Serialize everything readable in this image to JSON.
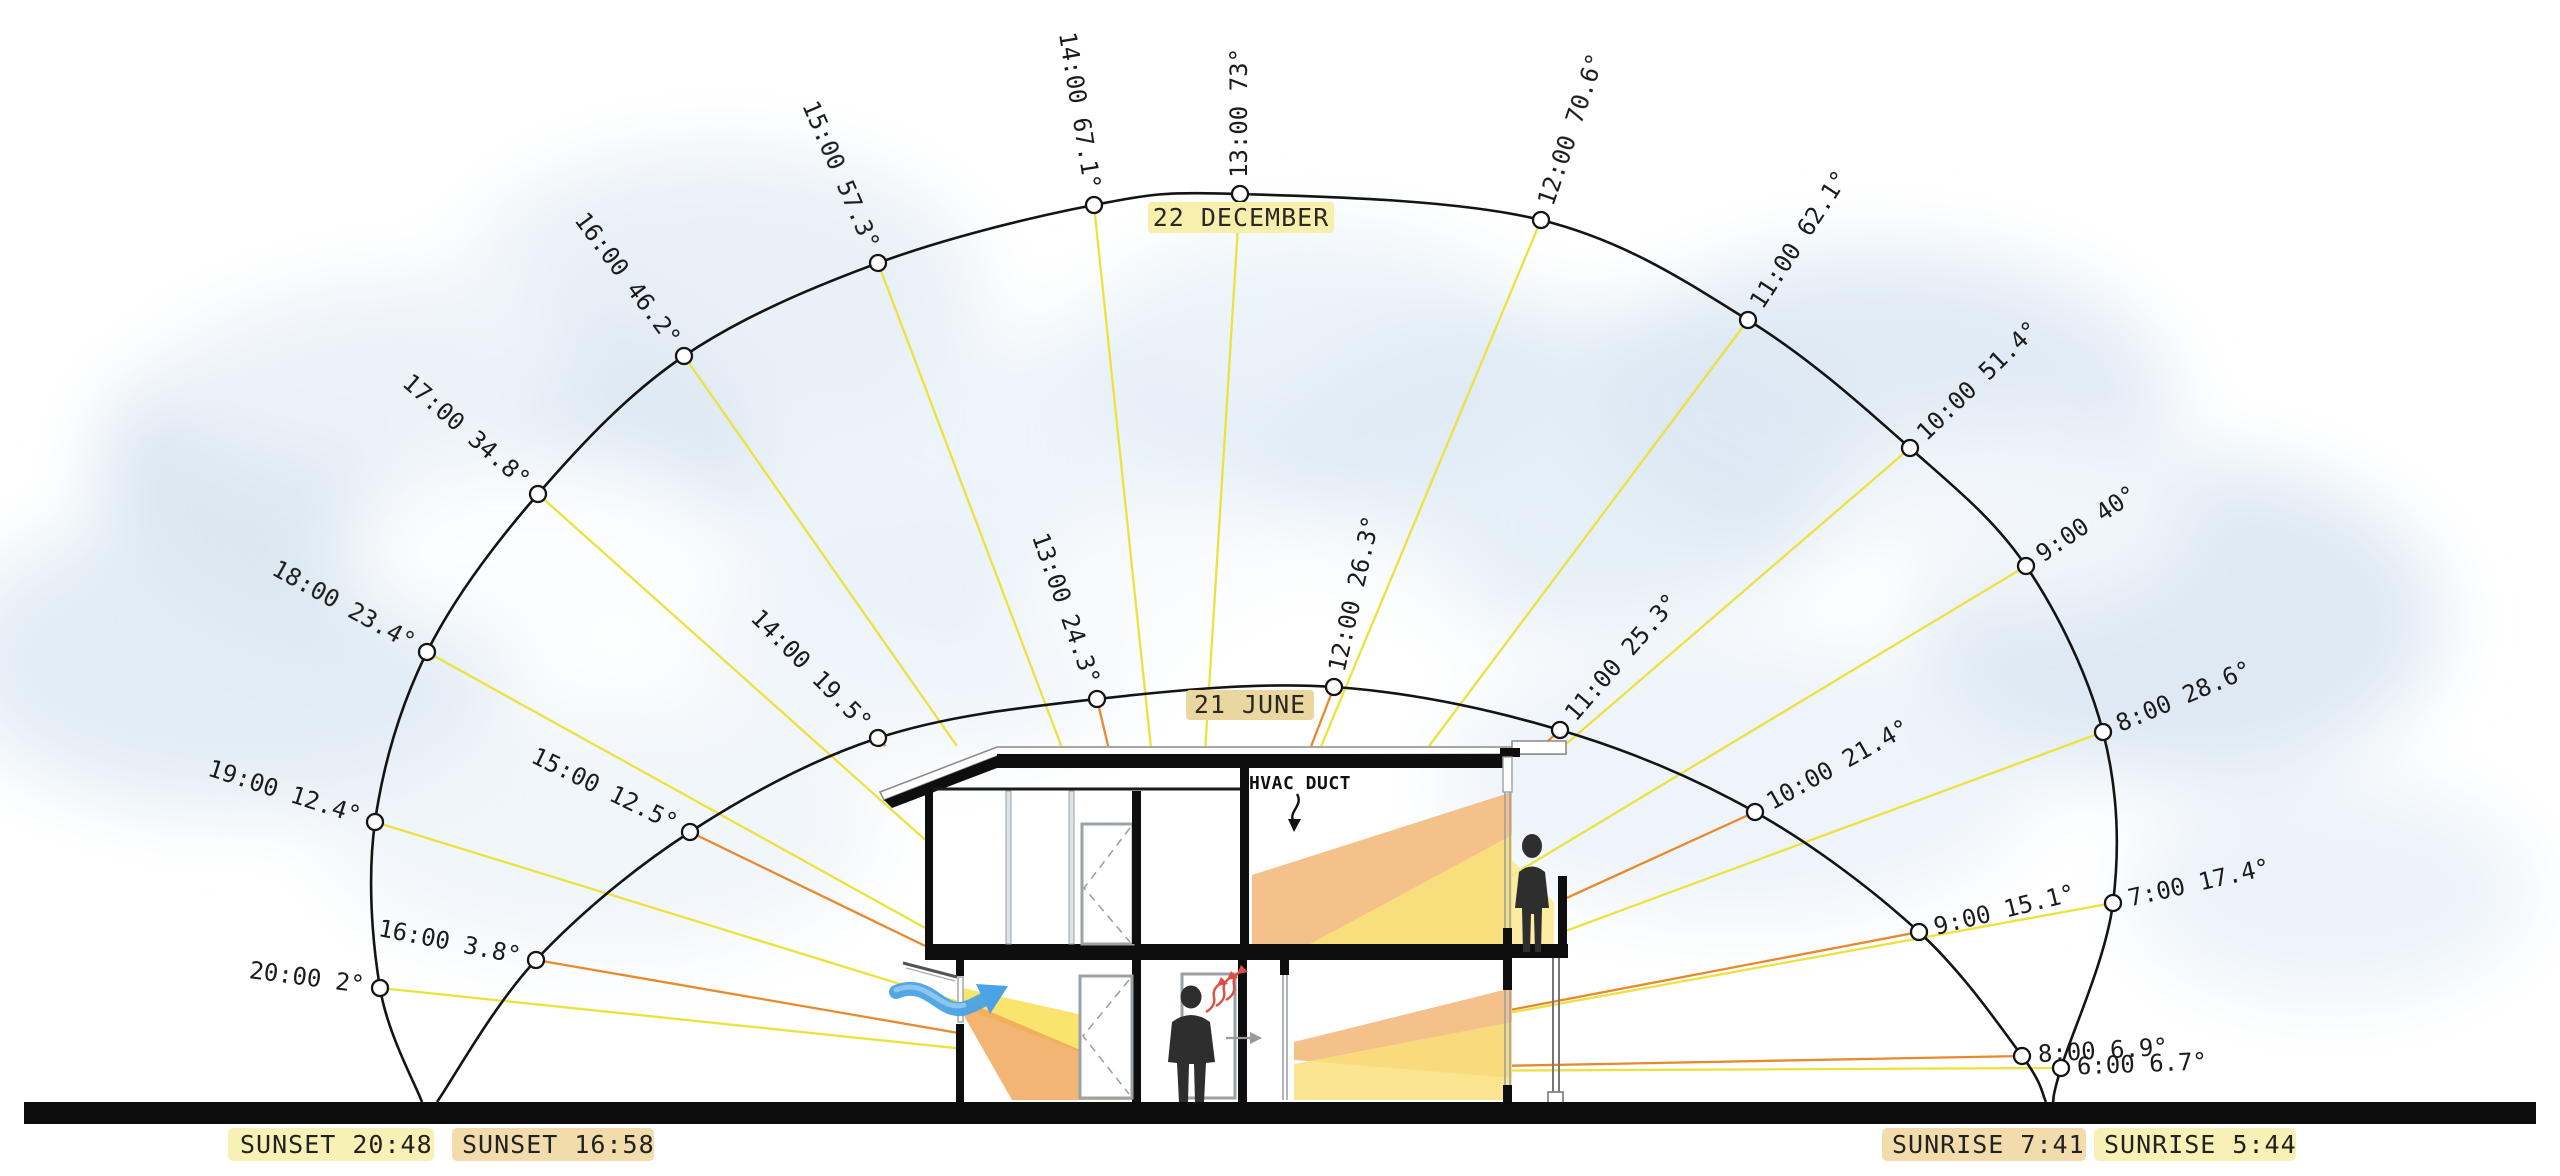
{
  "chart_data": {
    "type": "sun-path-section-diagram",
    "description": "Solar section study: sun altitude arcs for 22 December and 21 June with hourly positions, rays cast onto a two-storey house section",
    "series": [
      {
        "name": "22 DECEMBER",
        "season_label": "22 DECEMBER",
        "ray_color": "#ece23e",
        "tag_highlight": "#f7efad",
        "sunset": "SUNSET 20:48",
        "sunrise": "SUNRISE 5:44",
        "ground_start": {
          "x": 422,
          "y": 1102
        },
        "ground_end": {
          "x": 2053,
          "y": 1102
        },
        "hours": [
          {
            "time": "20:00",
            "elevation": 2,
            "x": 380,
            "y": 988
          },
          {
            "time": "19:00",
            "elevation": 12.4,
            "x": 375,
            "y": 822
          },
          {
            "time": "18:00",
            "elevation": 23.4,
            "x": 427,
            "y": 652
          },
          {
            "time": "17:00",
            "elevation": 34.8,
            "x": 538,
            "y": 494
          },
          {
            "time": "16:00",
            "elevation": 46.2,
            "x": 684,
            "y": 356
          },
          {
            "time": "15:00",
            "elevation": 57.3,
            "x": 878,
            "y": 263
          },
          {
            "time": "14:00",
            "elevation": 67.1,
            "x": 1094,
            "y": 205
          },
          {
            "time": "13:00",
            "elevation": 73,
            "x": 1240,
            "y": 194
          },
          {
            "time": "12:00",
            "elevation": 70.6,
            "x": 1541,
            "y": 220
          },
          {
            "time": "11:00",
            "elevation": 62.1,
            "x": 1748,
            "y": 320
          },
          {
            "time": "10:00",
            "elevation": 51.4,
            "x": 1910,
            "y": 448
          },
          {
            "time": "9:00",
            "elevation": 40,
            "x": 2026,
            "y": 566
          },
          {
            "time": "8:00",
            "elevation": 28.6,
            "x": 2103,
            "y": 732
          },
          {
            "time": "7:00",
            "elevation": 17.4,
            "x": 2113,
            "y": 903
          },
          {
            "time": "6:00",
            "elevation": 6.7,
            "x": 2061,
            "y": 1068
          }
        ]
      },
      {
        "name": "21 JUNE",
        "season_label": "21 JUNE",
        "ray_color": "#e8892d",
        "tag_highlight": "#ead7a0",
        "sunset": "SUNSET 16:58",
        "sunrise": "SUNRISE 7:41",
        "ground_start": {
          "x": 437,
          "y": 1102
        },
        "ground_end": {
          "x": 2046,
          "y": 1102
        },
        "hours": [
          {
            "time": "16:00",
            "elevation": 3.8,
            "x": 536,
            "y": 960
          },
          {
            "time": "15:00",
            "elevation": 12.5,
            "x": 690,
            "y": 832
          },
          {
            "time": "14:00",
            "elevation": 19.5,
            "x": 878,
            "y": 738
          },
          {
            "time": "13:00",
            "elevation": 24.3,
            "x": 1097,
            "y": 699
          },
          {
            "time": "12:00",
            "elevation": 26.3,
            "x": 1334,
            "y": 687
          },
          {
            "time": "11:00",
            "elevation": 25.3,
            "x": 1560,
            "y": 730
          },
          {
            "time": "10:00",
            "elevation": 21.4,
            "x": 1755,
            "y": 812
          },
          {
            "time": "9:00",
            "elevation": 15.1,
            "x": 1919,
            "y": 932
          },
          {
            "time": "8:00",
            "elevation": 6.9,
            "x": 2022,
            "y": 1056
          }
        ]
      }
    ]
  },
  "labels": {
    "december_tag": "22 DECEMBER",
    "june_tag": "21 JUNE",
    "hvac": "HVAC DUCT"
  },
  "footer": {
    "items": [
      {
        "label": "SUNSET 20:48",
        "highlight": "#f7efad"
      },
      {
        "label": "SUNSET 16:58",
        "highlight": "#f2d8a3"
      },
      {
        "label": "SUNRISE 7:41",
        "highlight": "#f2d8a3"
      },
      {
        "label": "SUNRISE 5:44",
        "highlight": "#f7efad"
      }
    ]
  },
  "icons": {
    "airflow_arrow": "blue curved arrow showing cross-ventilation entering ground floor",
    "heat_rise_arrows": "red wavy arrows showing warm air rising off occupant",
    "hvac_flow_arrow": "black arrow from HVAC DUCT label pointing down into room",
    "sun_hour_marker": "open circle on sun path arc"
  },
  "colors": {
    "december_ray": "#ece23e",
    "june_ray": "#e8892d",
    "arc_stroke": "#141414",
    "ground_bar": "#0c0c0c",
    "sun_wedge_orange": "#f4b97a",
    "sun_wedge_yellow": "#f9e061",
    "airflow_blue": "#49a3e6",
    "heat_red": "#dd4f44",
    "sky_cloud": "#d8e5f1"
  }
}
